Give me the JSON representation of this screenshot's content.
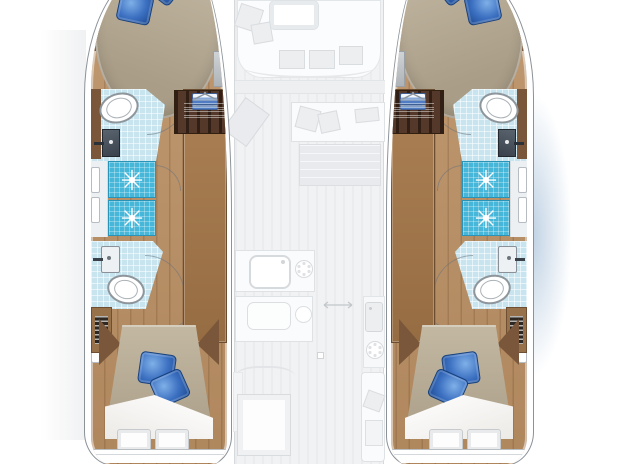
{
  "meta": {
    "type": "yacht-floorplan",
    "vessel": "catamaran",
    "view": "top-down interior deck plan, hulls rendered in colour, saloon deck ghosted",
    "text_labels": []
  },
  "colors": {
    "wood": "#b98e62",
    "wood-dark": "#7a573a",
    "stairs": "#54392b",
    "bed": "#a99d87",
    "duvet": "#ab9f89",
    "pillow": "#3b6fc0",
    "shower": "#47b7d9",
    "bath": "#c7e4ef",
    "sink": "#39424c",
    "hull-line": "#8b9298",
    "ghost-fill": "#fafbfc",
    "ghost-line": "#dfe2e5",
    "water": "rgba(150,180,210,0.62)"
  },
  "hull_rooms": [
    "forward double cabin with two blue pillows",
    "forward bathroom: toilet, dark washbasin",
    "shower stall 1",
    "shower stall 2",
    "aft bathroom: washbasin, toilet",
    "aft double cabin: duvet, two blue pillows, folded sheet, two white pillows",
    "wardrobe column with hangers, linen drawers and companionway stairs",
    "louvered locker at aft companion"
  ],
  "center_ghosted": [
    "forward cockpit with table and cushions",
    "saloon sofa with cushions and helm seat",
    "lounge pad",
    "galley counter with sink and stove",
    "second counter with sink and burner",
    "starboard galley strip with sink and stove",
    "dinette table with bench",
    "aft seat with pillows",
    "sliding-door double arrow"
  ],
  "counts": {
    "hulls": 2,
    "double_beds": 4,
    "blue_pillows_per_bed": 2,
    "white_pillows_per_aft_bed": 2,
    "shower_stalls_per_hull": 2,
    "toilets_per_hull": 2,
    "washbasins_per_hull": 2
  },
  "closet_stack": [
    {
      "type": "hangers",
      "h": 32
    },
    {
      "type": "drawers",
      "h": 30
    },
    {
      "type": "stairs",
      "h": 44
    },
    {
      "type": "drawer",
      "h": 20
    },
    {
      "type": "hangers",
      "h": 22
    },
    {
      "type": "gap",
      "h": 10
    },
    {
      "type": "drawers",
      "h": 28
    },
    {
      "type": "hangers",
      "h": 26
    },
    {
      "type": "gap",
      "h": 10
    },
    {
      "type": "drawer",
      "h": 18
    },
    {
      "type": "hangers",
      "h": 14
    }
  ]
}
